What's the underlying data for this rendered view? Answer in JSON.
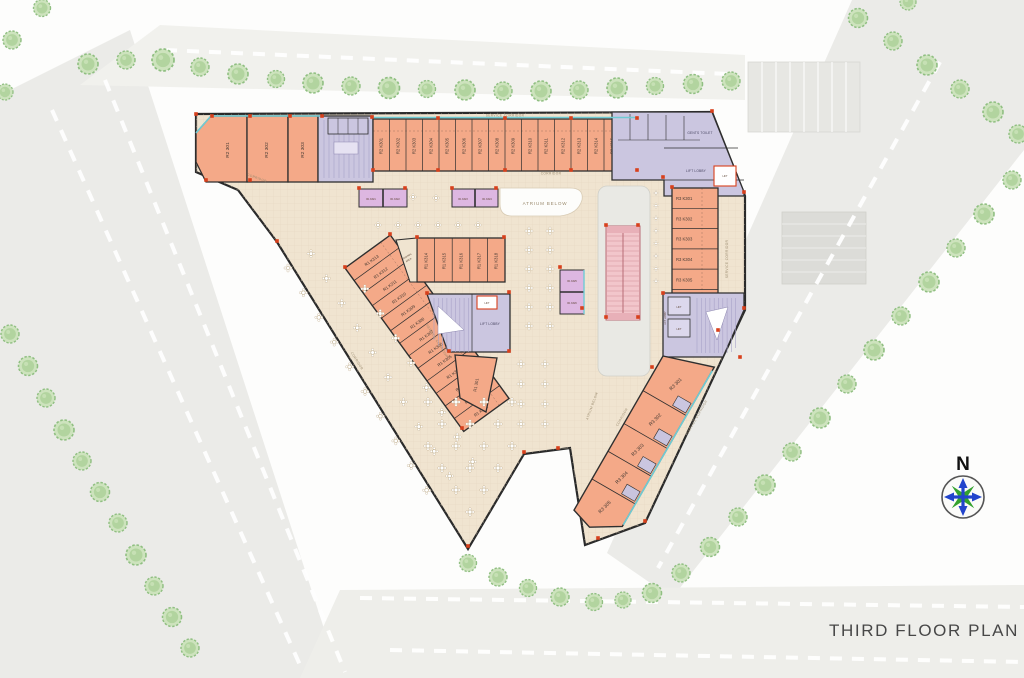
{
  "title": "THIRD FLOOR PLAN",
  "compass": {
    "north": "N"
  },
  "labels": {
    "service_corridor_top": "SERVICE CORRIDOR",
    "corridor_nw": "CORRIDOR",
    "corridor_top": "CORRIDOR",
    "atrium_center": "ATRIUM BELOW",
    "atrium_vertical": "ATRIUM BELOW",
    "corridor_se": "CORRIDOR",
    "service_corridor_right": "SERVICE CORRIDOR",
    "service_corridor_se": "SERVICE CORRIDOR",
    "service_corridor_mid": "SERVICE CORRIDOR",
    "corridor_wedge": "CORRIDOR",
    "washing_line1": "WASHING",
    "washing_line2": "AREA",
    "gents_toilet": "GENTS TOILET",
    "lift_lobby_ne": "LIFT LOBBY",
    "lift_ne": "LIFT",
    "lift_lobby_center": "LIFT LOBBY",
    "lift_center": "LIFT",
    "lift_lobby_east": "LIFT LOBBY",
    "lift_east_1": "LIFT",
    "lift_east_2": "LIFT"
  },
  "units": {
    "r2_large": [
      "R2 301",
      "R2 302",
      "R2 303"
    ],
    "r2_kiosks": [
      "R2 K301",
      "R2 K302",
      "R2 K303",
      "R2 K304",
      "R2 K305",
      "R2 K306",
      "R2 K307",
      "R2 K308",
      "R2 K309",
      "R2 K310",
      "R2 K311",
      "R2 K312",
      "R2 K313",
      "R2 K314",
      "R2 K315",
      "R2 K316"
    ],
    "r3_kiosks": [
      "R3 K301",
      "R3 K302",
      "R3 K303",
      "R3 K304",
      "R3 K305",
      "R3 K306",
      "R3 K307"
    ],
    "r3_large": [
      "R3 301",
      "R3 302",
      "R3 303",
      "R3 304",
      "R3 305"
    ],
    "r1_diag": [
      "R1 K313",
      "R1 K312",
      "R1 K311",
      "R1 K310",
      "R1 K309",
      "R1 K308",
      "R1 K307",
      "R1 K306",
      "R1 K305",
      "R1 K304",
      "R1 K303",
      "R1 K302",
      "R1 K301"
    ],
    "r1_mid": [
      "R1 K314",
      "R1 K315",
      "R1 K316",
      "R1 K317",
      "R1 K318"
    ],
    "r1_food": [
      "R1 K321",
      "R1 K322",
      "R1 K323",
      "R1 K324"
    ],
    "r1_center": [
      "R1 K325",
      "R1 K326"
    ],
    "r1_large": "R1 301"
  },
  "colors": {
    "unit_fill": "#f4a988",
    "core_fill": "#cbc6e0",
    "kiosk_fill": "#ddb7e1",
    "escalator_fill": "#f2c6cb",
    "floor_fill": "#f0e4d0",
    "accent_red": "#d8401c",
    "accent_teal": "#6fcbd4",
    "tree_green": "#b2d49f",
    "road_gray": "#ebebe8"
  }
}
